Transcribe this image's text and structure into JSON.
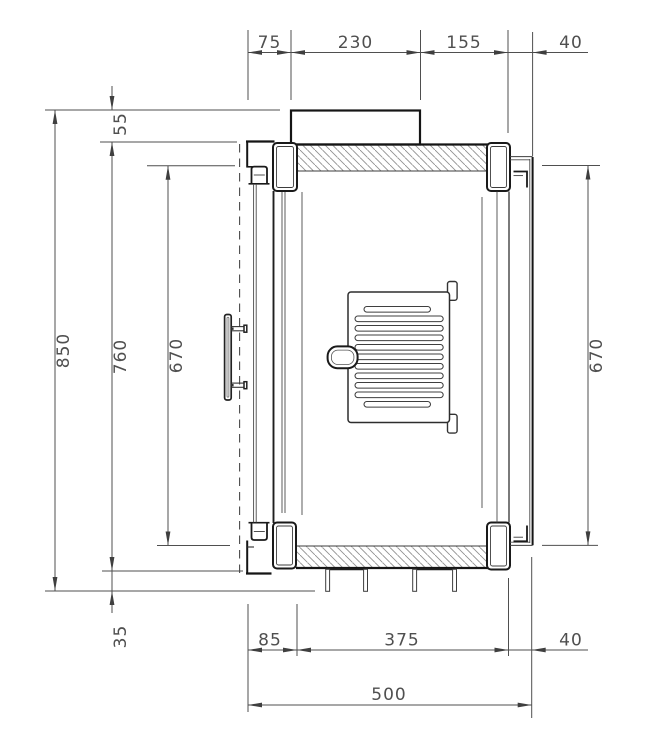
{
  "drawing": {
    "kind": "technical-dimension-drawing",
    "subject": "stove-side-section"
  },
  "dimensions": {
    "top": [
      "75",
      "230",
      "155",
      "40"
    ],
    "left": [
      "55",
      "850",
      "760",
      "670",
      "35"
    ],
    "right": [
      "670"
    ],
    "bottom": [
      "85",
      "375",
      "40",
      "500"
    ]
  },
  "colors": {
    "contour": "#151515",
    "dimension_lines": "#4f4f4f",
    "hatch": "#909090",
    "background": "#ffffff"
  }
}
